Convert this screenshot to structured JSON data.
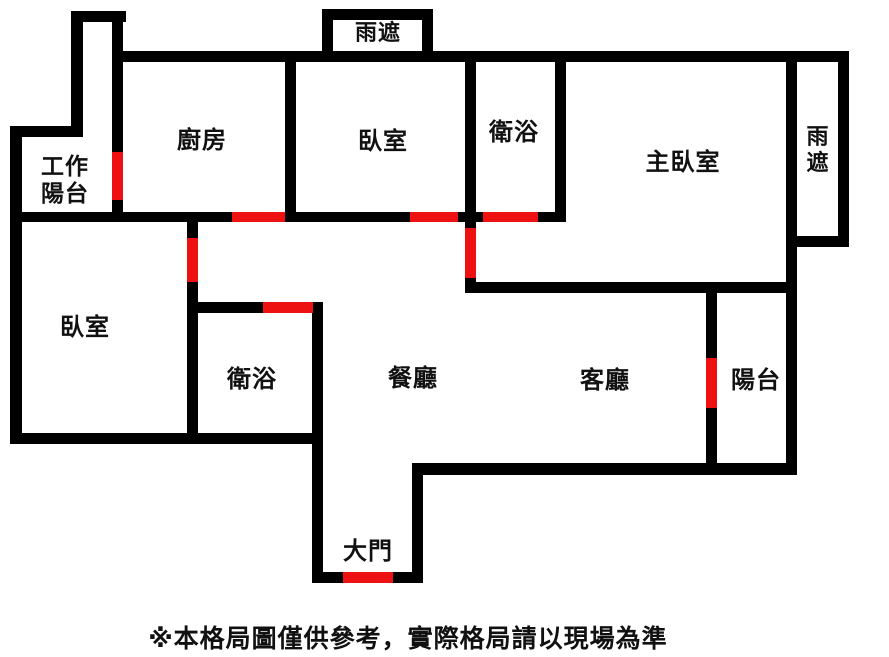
{
  "canvas": {
    "width": 889,
    "height": 657,
    "background": "#ffffff"
  },
  "colors": {
    "wall": "#000000",
    "door": "#ee1111",
    "text": "#111111"
  },
  "footer": {
    "note": "※本格局圖僅供參考，實際格局請以現場為準"
  },
  "plan": {
    "rooms": [
      {
        "id": "work-balcony",
        "lines": [
          "工作",
          "陽台"
        ],
        "x": 65,
        "y": 180,
        "fs": 23
      },
      {
        "id": "kitchen",
        "lines": [
          "廚房"
        ],
        "x": 202,
        "y": 141,
        "fs": 24
      },
      {
        "id": "bedroom-top",
        "lines": [
          "臥室"
        ],
        "x": 383,
        "y": 142,
        "fs": 24
      },
      {
        "id": "bathroom-top",
        "lines": [
          "衛浴"
        ],
        "x": 514,
        "y": 133,
        "fs": 24
      },
      {
        "id": "master-bedroom",
        "lines": [
          "主臥室"
        ],
        "x": 683,
        "y": 163,
        "fs": 24
      },
      {
        "id": "rain-shelter-top",
        "lines": [
          "雨遮"
        ],
        "x": 378,
        "y": 33,
        "fs": 22
      },
      {
        "id": "rain-shelter-right",
        "lines": [
          "雨",
          "遮"
        ],
        "x": 818,
        "y": 150,
        "fs": 22
      },
      {
        "id": "bedroom-left",
        "lines": [
          "臥室"
        ],
        "x": 85,
        "y": 328,
        "fs": 24
      },
      {
        "id": "bathroom-bottom",
        "lines": [
          "衛浴"
        ],
        "x": 252,
        "y": 380,
        "fs": 24
      },
      {
        "id": "dining-room",
        "lines": [
          "餐廳"
        ],
        "x": 413,
        "y": 379,
        "fs": 24
      },
      {
        "id": "living-room",
        "lines": [
          "客廳"
        ],
        "x": 605,
        "y": 381,
        "fs": 24
      },
      {
        "id": "balcony",
        "lines": [
          "陽台"
        ],
        "x": 756,
        "y": 381,
        "fs": 24
      },
      {
        "id": "main-door",
        "lines": [
          "大門"
        ],
        "x": 368,
        "y": 552,
        "fs": 24
      }
    ],
    "walls": [
      {
        "name": "outer-left",
        "x": 10,
        "y": 126,
        "w": 12,
        "h": 318
      },
      {
        "name": "notch-top",
        "x": 10,
        "y": 126,
        "w": 73,
        "h": 11
      },
      {
        "name": "work-balcony-left",
        "x": 71,
        "y": 11,
        "w": 12,
        "h": 126
      },
      {
        "name": "work-balcony-cap",
        "x": 71,
        "y": 11,
        "w": 55,
        "h": 11
      },
      {
        "name": "work-balcony-right",
        "x": 112,
        "y": 11,
        "w": 11,
        "h": 211
      },
      {
        "name": "top-outer",
        "x": 112,
        "y": 51,
        "w": 737,
        "h": 11
      },
      {
        "name": "rain-top-left",
        "x": 322,
        "y": 9,
        "w": 11,
        "h": 48
      },
      {
        "name": "rain-top-cap",
        "x": 322,
        "y": 9,
        "w": 111,
        "h": 11
      },
      {
        "name": "rain-top-right",
        "x": 422,
        "y": 9,
        "w": 11,
        "h": 48
      },
      {
        "name": "kitchen-bedroom-divider",
        "x": 285,
        "y": 51,
        "w": 11,
        "h": 171
      },
      {
        "name": "bedroom-bath-divider",
        "x": 465,
        "y": 51,
        "w": 11,
        "h": 171
      },
      {
        "name": "bath-master-divider",
        "x": 555,
        "y": 51,
        "w": 11,
        "h": 171
      },
      {
        "name": "main-horizontal",
        "x": 10,
        "y": 212,
        "w": 556,
        "h": 10
      },
      {
        "name": "master-door-wall",
        "x": 465,
        "y": 212,
        "w": 11,
        "h": 81
      },
      {
        "name": "master-bottom",
        "x": 465,
        "y": 282,
        "w": 332,
        "h": 11
      },
      {
        "name": "outer-right",
        "x": 786,
        "y": 51,
        "w": 11,
        "h": 424
      },
      {
        "name": "rain-right-outer",
        "x": 838,
        "y": 51,
        "w": 11,
        "h": 196
      },
      {
        "name": "rain-right-bottom",
        "x": 786,
        "y": 236,
        "w": 63,
        "h": 11
      },
      {
        "name": "left-bedroom-divider",
        "x": 187,
        "y": 212,
        "w": 11,
        "h": 232
      },
      {
        "name": "bath-bottom-top",
        "x": 187,
        "y": 302,
        "w": 136,
        "h": 11
      },
      {
        "name": "bath-bottom-right",
        "x": 312,
        "y": 302,
        "w": 11,
        "h": 281
      },
      {
        "name": "bottom-left",
        "x": 10,
        "y": 433,
        "w": 313,
        "h": 11
      },
      {
        "name": "entry-bottom",
        "x": 312,
        "y": 572,
        "w": 111,
        "h": 11
      },
      {
        "name": "entry-right",
        "x": 412,
        "y": 463,
        "w": 11,
        "h": 120
      },
      {
        "name": "bottom-main",
        "x": 412,
        "y": 463,
        "w": 385,
        "h": 12
      },
      {
        "name": "balcony-divider",
        "x": 706,
        "y": 282,
        "w": 11,
        "h": 193
      }
    ],
    "doors": [
      {
        "name": "door-work-balcony",
        "x": 112,
        "y": 152,
        "w": 11,
        "h": 48
      },
      {
        "name": "door-kitchen",
        "x": 232,
        "y": 212,
        "w": 53,
        "h": 10
      },
      {
        "name": "door-bedroom-top",
        "x": 410,
        "y": 212,
        "w": 48,
        "h": 10
      },
      {
        "name": "door-bath-top",
        "x": 483,
        "y": 212,
        "w": 55,
        "h": 10
      },
      {
        "name": "door-master",
        "x": 465,
        "y": 228,
        "w": 11,
        "h": 50
      },
      {
        "name": "door-bedroom-left",
        "x": 187,
        "y": 238,
        "w": 11,
        "h": 44
      },
      {
        "name": "door-bath-bottom",
        "x": 263,
        "y": 302,
        "w": 50,
        "h": 11
      },
      {
        "name": "door-balcony",
        "x": 706,
        "y": 358,
        "w": 11,
        "h": 50
      },
      {
        "name": "door-entry",
        "x": 343,
        "y": 572,
        "w": 50,
        "h": 11
      }
    ]
  }
}
